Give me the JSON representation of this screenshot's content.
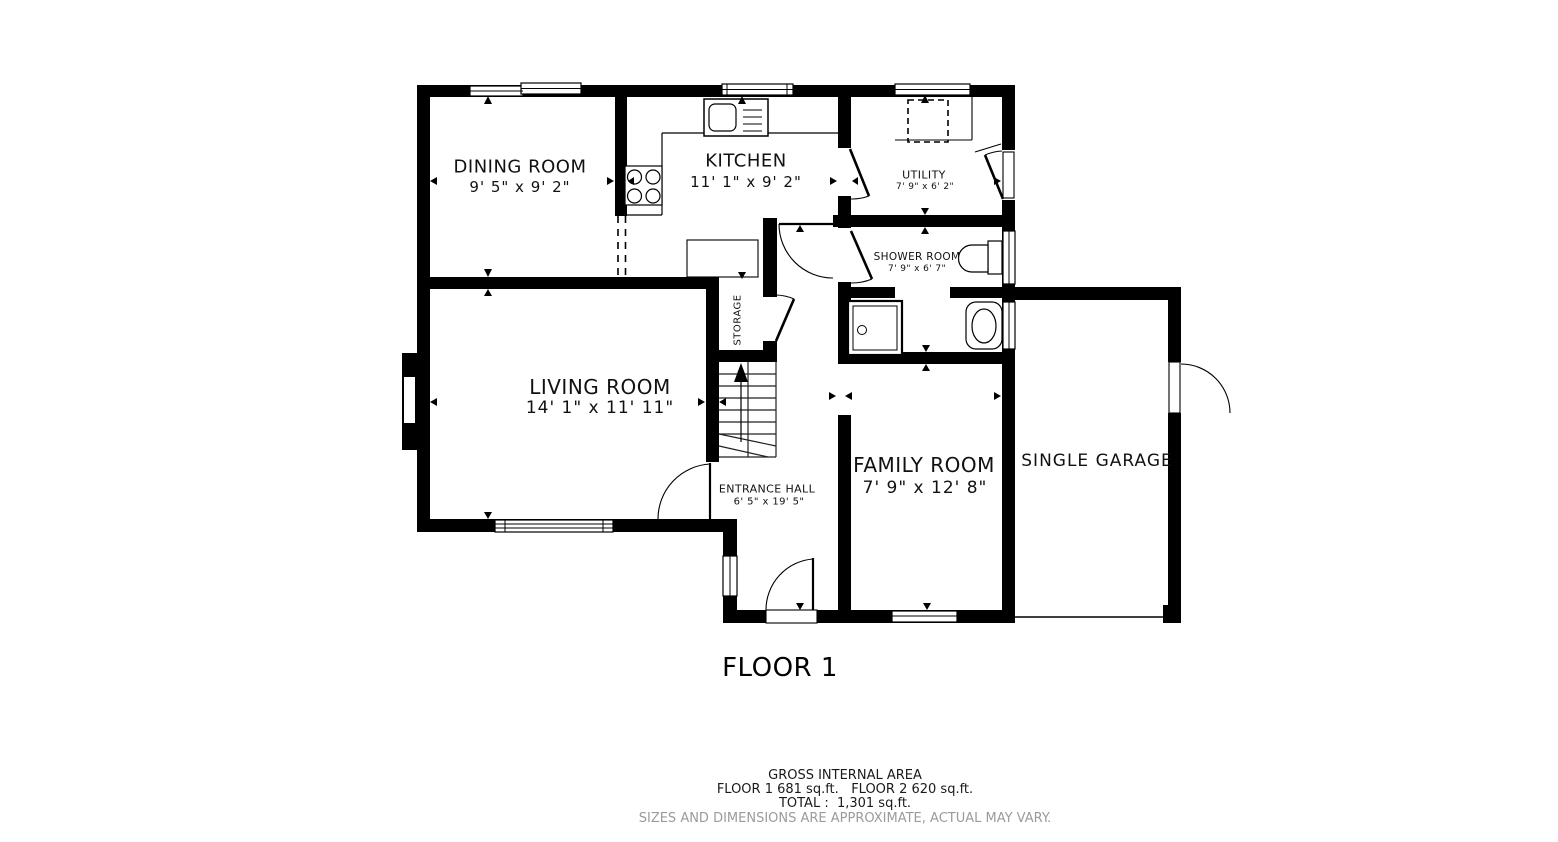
{
  "plan": {
    "title": "FLOOR 1",
    "rooms": {
      "dining": {
        "name": "DINING ROOM",
        "dims": "9' 5\" x 9' 2\""
      },
      "kitchen": {
        "name": "KITCHEN",
        "dims": "11' 1\" x 9' 2\""
      },
      "utility": {
        "name": "UTILITY",
        "dims": "7' 9\" x 6' 2\""
      },
      "shower": {
        "name": "SHOWER ROOM",
        "dims": "7' 9\" x 6' 7\""
      },
      "storage": {
        "name": "STORAGE"
      },
      "living": {
        "name": "LIVING ROOM",
        "dims": "14' 1\" x 11' 11\""
      },
      "hall": {
        "name": "ENTRANCE HALL",
        "dims": "6' 5\" x 19' 5\""
      },
      "family": {
        "name": "FAMILY ROOM",
        "dims": "7' 9\" x 12' 8\""
      },
      "garage": {
        "name": "SINGLE GARAGE"
      }
    },
    "footer": {
      "line1": "GROSS INTERNAL AREA",
      "line2": "FLOOR 1 681 sq.ft.   FLOOR 2 620 sq.ft.",
      "line3": "TOTAL :  1,301 sq.ft.",
      "line4": "SIZES AND DIMENSIONS ARE APPROXIMATE, ACTUAL MAY VARY."
    },
    "colors": {
      "wall": "#000000",
      "background": "#ffffff",
      "approx_note": "#9b9b9b"
    }
  }
}
